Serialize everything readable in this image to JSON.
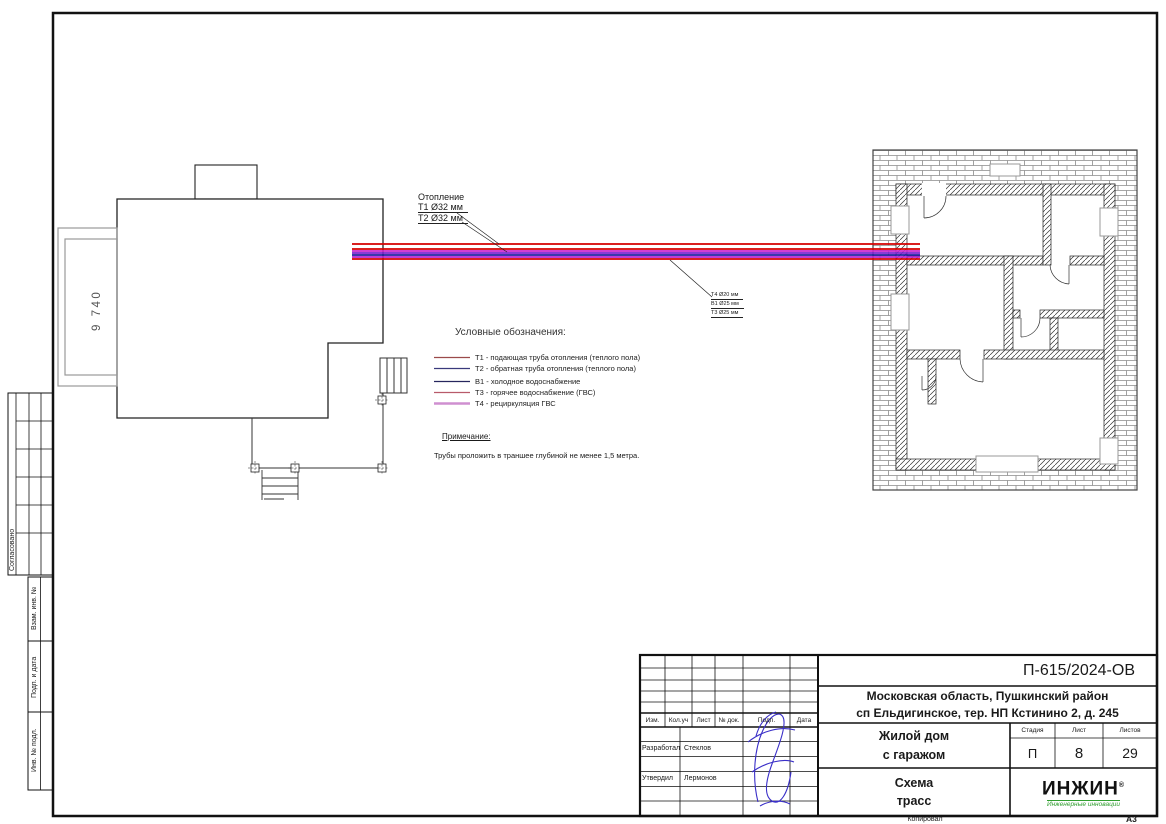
{
  "sheet": {
    "doc_code": "П-615/2024-ОВ",
    "address_line1": "Московская область, Пушкинский район",
    "address_line2": "сп Ельдигинское, тер. НП Кстинино 2, д. 245",
    "object_line1": "Жилой дом",
    "object_line2": "с гаражом",
    "drawing_title_line1": "Схема",
    "drawing_title_line2": "трасс",
    "stage_label": "Стадия",
    "stage_value": "П",
    "sheet_label": "Лист",
    "sheet_value": "8",
    "sheets_label": "Листов",
    "sheets_value": "29",
    "header_cols": {
      "izm": "Изм.",
      "kol_uch": "Кол.уч",
      "list": "Лист",
      "no_dok": "№ док.",
      "podp": "Подп.",
      "data": "Дата"
    },
    "developed_label": "Разработал",
    "developed_name": "Стеклов",
    "approved_label": "Утвердил",
    "approved_name": "Лермонов",
    "copied_label": "Копировал",
    "format_label": "А3"
  },
  "logo": {
    "name": "ИНЖИН",
    "reg_mark": "®",
    "tagline": "Инженерные инновации",
    "text_color": "#111111",
    "accent_color": "#2f9e2f"
  },
  "margin_labels": {
    "approved": "Согласовано",
    "vzam_inv": "Взам. инв. №",
    "podp_data": "Подп. и дата",
    "inv_podl": "Инв. № подл."
  },
  "plan": {
    "dimension": "9 740",
    "heating_callout": {
      "title": "Отопление",
      "pipe1": "Т1 Ø32 мм",
      "pipe2": "Т2 Ø32 мм"
    },
    "water_callout": {
      "pipe1": "Т4 Ø20 мм",
      "pipe2": "В1 Ø25 мм",
      "pipe3": "Т3 Ø25 мм"
    }
  },
  "legend": {
    "title": "Условные обозначения:",
    "items": [
      {
        "label": "Т1 - подающая труба отопления (теплого пола)",
        "color": "#9b4a4a"
      },
      {
        "label": "Т2 - обратная труба отопления (теплого пола)",
        "color": "#3a3a7c"
      },
      {
        "label": "В1 - холодное водоснабжение",
        "color": "#26265e"
      },
      {
        "label": "Т3 - горячее водоснабжение (ГВС)",
        "color": "#b85a6a"
      },
      {
        "label": "Т4 - рециркуляция ГВС",
        "color": "#cf8fd0"
      }
    ]
  },
  "note": {
    "title": "Примечание:",
    "text": "Трубы проложить в траншее глубиной не менее 1,5 метра."
  },
  "pipes": {
    "stripe_colors": [
      "#d40000",
      "#d40000",
      "#cc22cc",
      "#7a1fd0",
      "#1d1da0",
      "#b81fd0",
      "#d40000"
    ]
  }
}
